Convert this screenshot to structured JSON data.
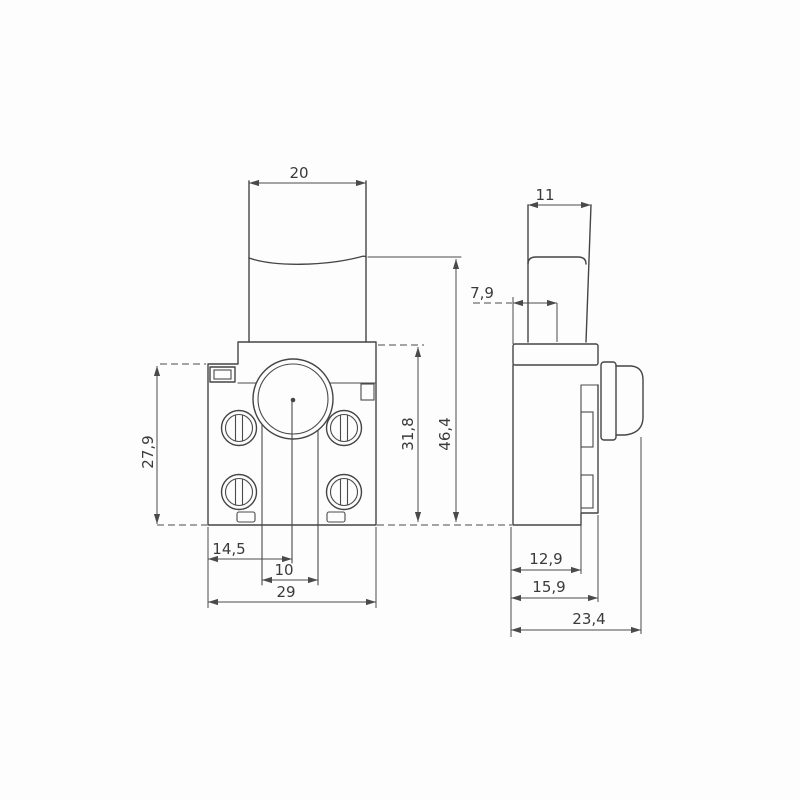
{
  "drawing": {
    "background": "#fdfdfd",
    "line_color": "#454545",
    "text_color": "#3a3a3a",
    "front_view": {
      "dims": {
        "trigger_width": "20",
        "height_left": "27,9",
        "body_height": "31,8",
        "total_height": "46,4",
        "hole_offset": "14,5",
        "slot_width": "10",
        "body_width": "29"
      }
    },
    "side_view": {
      "dims": {
        "trigger_depth": "11",
        "trigger_offset": "7,9",
        "inner_depth": "12,9",
        "body_depth": "15,9",
        "total_depth": "23,4"
      }
    }
  }
}
